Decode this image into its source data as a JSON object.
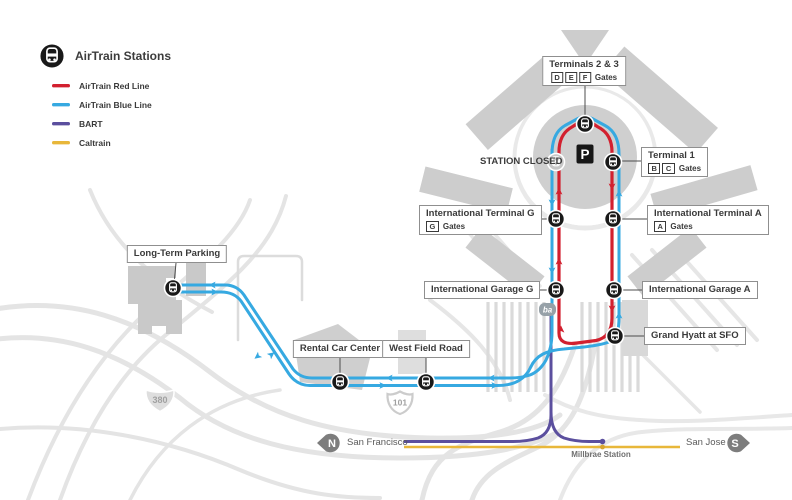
{
  "legend": {
    "title": "AirTrain Stations",
    "items": [
      {
        "id": "airtrain-red",
        "label": "AirTrain Red Line",
        "color": "#d2202f"
      },
      {
        "id": "airtrain-blue",
        "label": "AirTrain Blue Line",
        "color": "#36a9e1"
      },
      {
        "id": "bart",
        "label": "BART",
        "color": "#5b4f9e"
      },
      {
        "id": "caltrain",
        "label": "Caltrain",
        "color": "#e8b73a"
      }
    ]
  },
  "stations": {
    "terminals_2_3": {
      "name": "Terminals 2 & 3",
      "gates": [
        "D",
        "E",
        "F"
      ],
      "gates_label": "Gates"
    },
    "terminal_1": {
      "name": "Terminal 1",
      "gates": [
        "B",
        "C"
      ],
      "gates_label": "Gates"
    },
    "intl_terminal_a": {
      "name": "International Terminal A",
      "gates": [
        "A"
      ],
      "gates_label": "Gates"
    },
    "intl_terminal_g": {
      "name": "International Terminal G",
      "gates": [
        "G"
      ],
      "gates_label": "Gates"
    },
    "intl_garage_a": {
      "name": "International Garage A"
    },
    "intl_garage_g": {
      "name": "International Garage G"
    },
    "grand_hyatt": {
      "name": "Grand Hyatt at SFO"
    },
    "long_term_parking": {
      "name": "Long-Term Parking"
    },
    "rental_car_center": {
      "name": "Rental Car Center"
    },
    "west_field_road": {
      "name": "West Field Road"
    }
  },
  "map": {
    "station_closed": "STATION CLOSED",
    "parking_symbol": "P",
    "bart_logo": "ba",
    "highway_380": "380",
    "highway_101": "101",
    "north_letter": "N",
    "south_letter": "S",
    "san_francisco": "San Francisco",
    "san_jose": "San Jose",
    "millbrae": "Millbrae Station"
  }
}
